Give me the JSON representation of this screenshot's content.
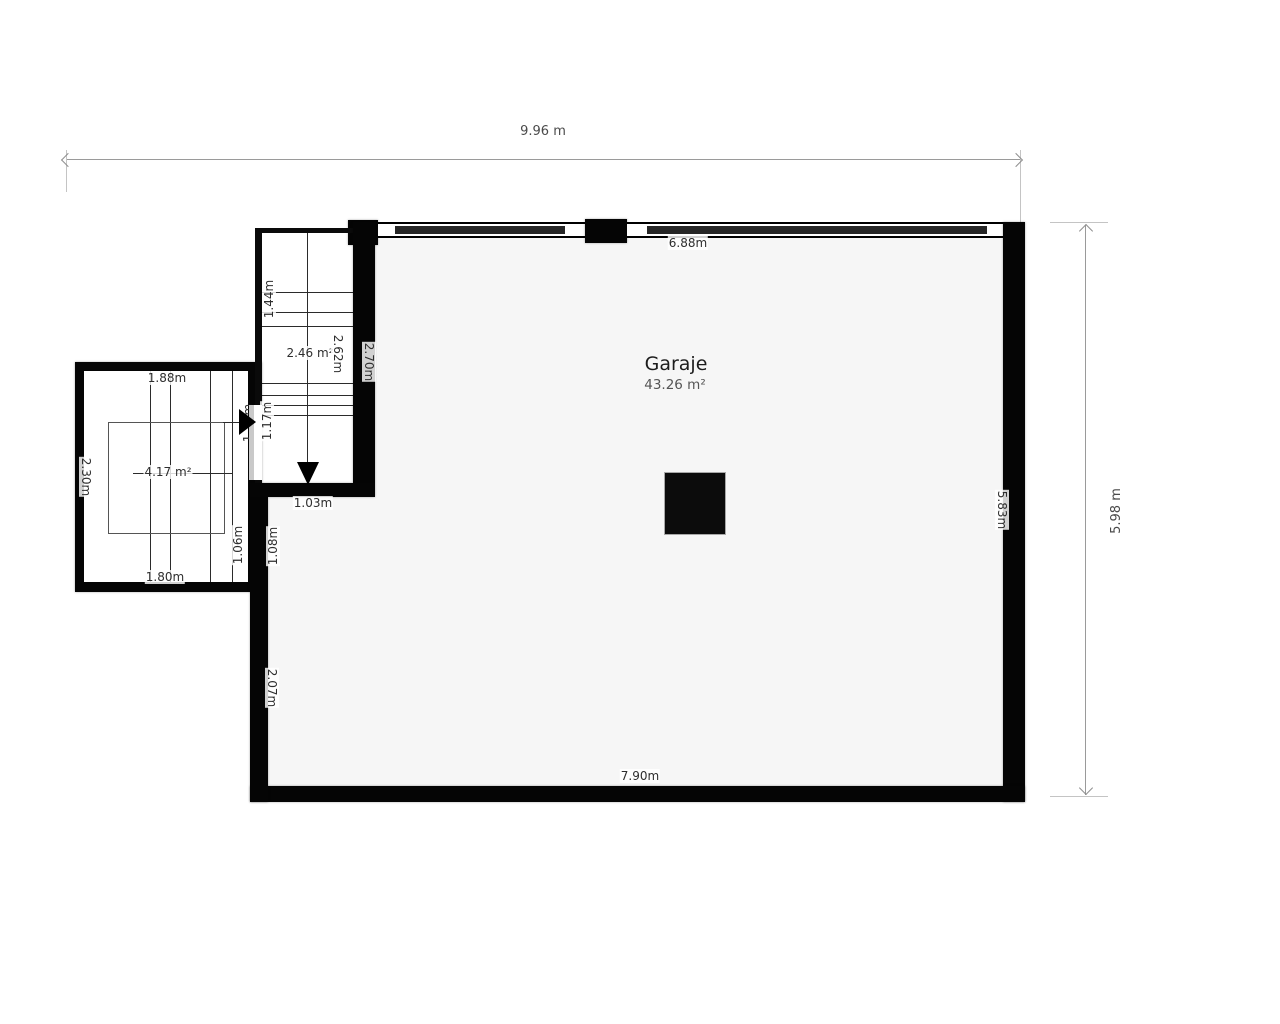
{
  "room": {
    "name": "Garaje",
    "area": "43.26 m²"
  },
  "overall_dimensions": {
    "width": "9.96 m",
    "height": "5.98 m"
  },
  "garage_walls": {
    "top_window_span": "6.88m",
    "bottom": "7.90m",
    "right": "5.83m",
    "left_lower": "2.07m",
    "left_segment_inner": "1.08m"
  },
  "stair_corridor": {
    "area": "2.46 m²",
    "width": "1.03m",
    "length": "2.62m",
    "wall_length": "2.70m",
    "flight_upper": "1.44m",
    "flight_lower": "1.17m",
    "flight_lower_dup": "1.17m"
  },
  "stair_box": {
    "area": "4.17 m²",
    "top": "1.88m",
    "left": "2.30m",
    "bottom": "1.80m",
    "right_segment": "1.06m"
  }
}
